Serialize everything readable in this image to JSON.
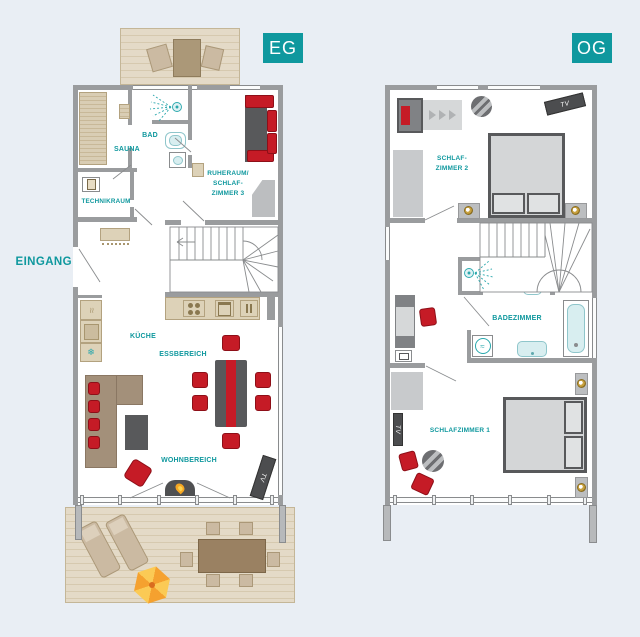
{
  "plans": {
    "eg": {
      "label": "EG",
      "entrance_label": "EINGANG",
      "tv_label": "TV",
      "rooms": {
        "sauna": "SAUNA",
        "bad": "BAD",
        "technikraum": "TECHNIKRAUM",
        "ruheraum_line1": "RUHERAUM/",
        "ruheraum_line2": "SCHLAF-",
        "ruheraum_line3": "ZIMMER 3",
        "kueche": "KÜCHE",
        "essbereich": "ESSBEREICH",
        "wohnbereich": "WOHNBEREICH"
      }
    },
    "og": {
      "label": "OG",
      "tv_label_top": "TV",
      "tv_label_bottom": "TV",
      "rooms": {
        "schlafzimmer2_line1": "SCHLAF-",
        "schlafzimmer2_line2": "ZIMMER 2",
        "badezimmer": "BADEZIMMER",
        "schlafzimmer1": "SCHLAFZIMMER 1"
      }
    }
  },
  "icons": {
    "snowflake_glyph": "❄",
    "waves_glyph": "≈"
  },
  "colors": {
    "background": "#e9eef4",
    "accent_teal": "#0f989e",
    "wall_gray": "#9a9c9e",
    "accent_red": "#c51b26",
    "furniture_dark_gray": "#58595b",
    "furniture_light_gray": "#c8cacc",
    "wood_light": "#e4dac7",
    "wood_dark": "#9a8162",
    "counter_tan": "#ddd2b8",
    "fixture_teal": "#d8eef0",
    "lamp_gold": "#c9a23f",
    "umbrella_orange": "#f5a12f",
    "umbrella_yellow": "#fbca55",
    "flame_orange": "#f5a623"
  }
}
